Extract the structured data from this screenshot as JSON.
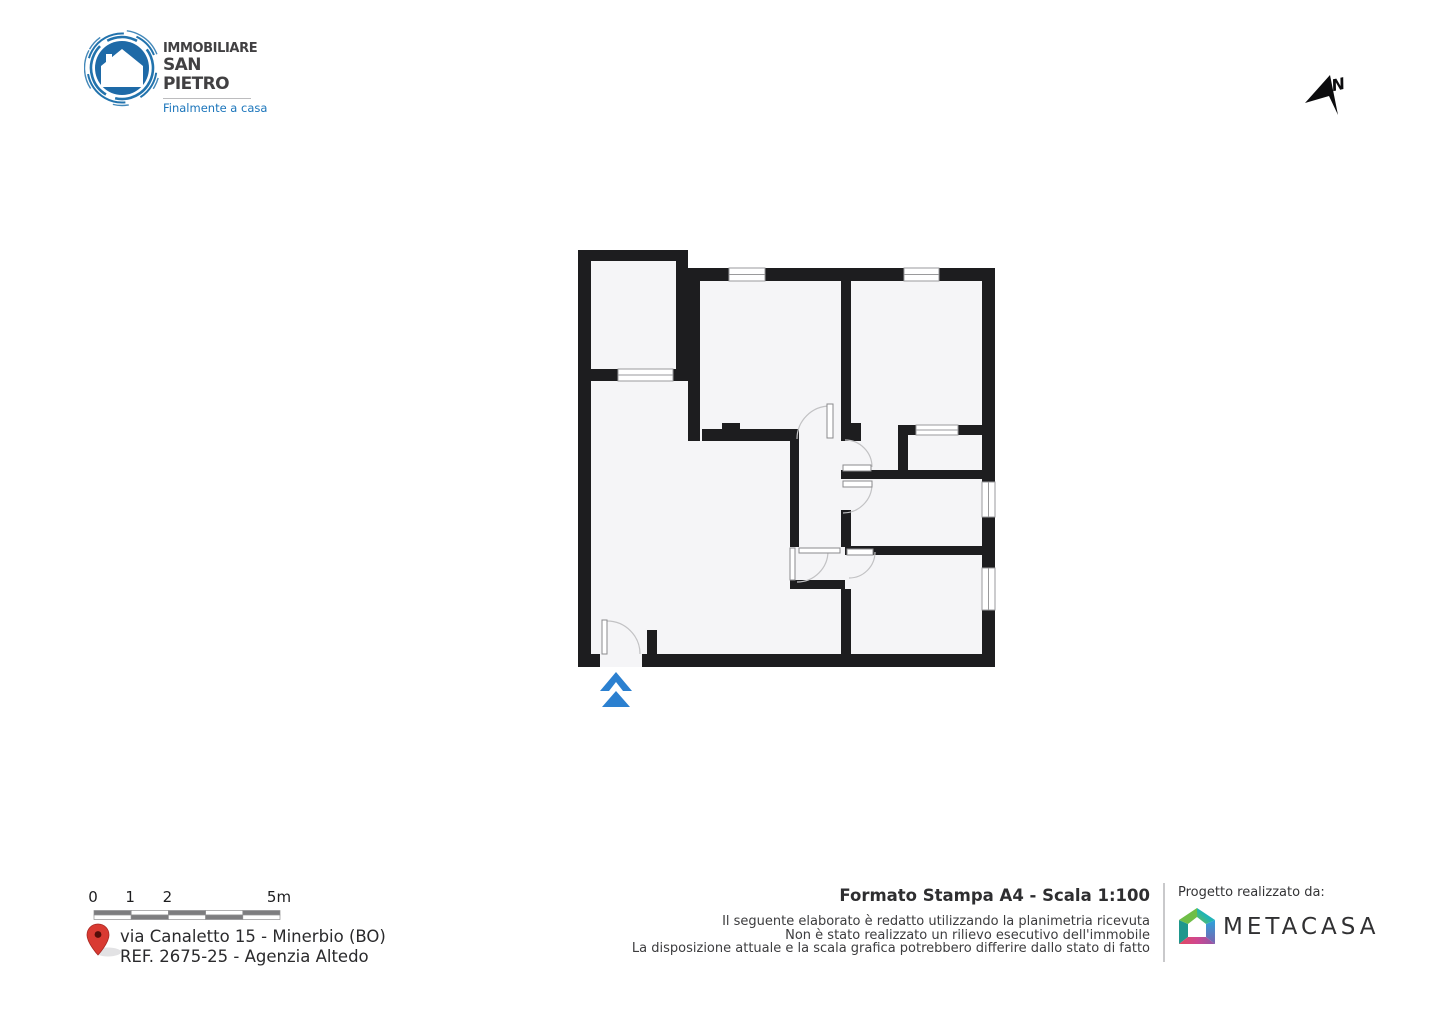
{
  "branding": {
    "line1": "IMMOBILIARE",
    "line2": "SAN PIETRO",
    "tagline": "Finalmente a casa",
    "brand_blue": "#1e6aa7",
    "tagline_blue": "#1b75bb"
  },
  "north_indicator": {
    "label": "N"
  },
  "floor_plan": {
    "wall_color": "#1d1d1f",
    "room_fill": "#f5f5f7",
    "window_stroke": "#9a9a9c",
    "arc_stroke": "#c2c2c4",
    "entrance_arrow_color": "#2b80d0",
    "outline_polygon": "578,250 688,250 688,268 995,268 995,667 578,667",
    "walls": [
      [
        578,
        250,
        13,
        417
      ],
      [
        578,
        250,
        110,
        11
      ],
      [
        676,
        261,
        12,
        120
      ],
      [
        578,
        369,
        40,
        12
      ],
      [
        673,
        369,
        15,
        12
      ],
      [
        688,
        268,
        41,
        13
      ],
      [
        765,
        268,
        139,
        13
      ],
      [
        939,
        268,
        56,
        13
      ],
      [
        982,
        268,
        13,
        214
      ],
      [
        982,
        517,
        13,
        51
      ],
      [
        982,
        610,
        13,
        57
      ],
      [
        578,
        654,
        22,
        13
      ],
      [
        642,
        654,
        353,
        13
      ],
      [
        688,
        281,
        12,
        160
      ],
      [
        841,
        281,
        10,
        142
      ],
      [
        841,
        423,
        20,
        18
      ],
      [
        702,
        429,
        95,
        12
      ],
      [
        722,
        423,
        18,
        18
      ],
      [
        790,
        429,
        9,
        118
      ],
      [
        841,
        470,
        141,
        9
      ],
      [
        841,
        510,
        10,
        37
      ],
      [
        898,
        425,
        10,
        45
      ],
      [
        898,
        425,
        18,
        10
      ],
      [
        958,
        425,
        24,
        10
      ],
      [
        845,
        546,
        137,
        9
      ],
      [
        790,
        580,
        55,
        9
      ],
      [
        841,
        589,
        10,
        65
      ],
      [
        647,
        630,
        10,
        24
      ]
    ],
    "windows": [
      {
        "rect": [
          729,
          268,
          36,
          13
        ],
        "dir": "h"
      },
      {
        "rect": [
          904,
          268,
          35,
          13
        ],
        "dir": "h"
      },
      {
        "rect": [
          618,
          369,
          55,
          12
        ],
        "dir": "h"
      },
      {
        "rect": [
          916,
          425,
          42,
          10
        ],
        "dir": "h"
      },
      {
        "rect": [
          982,
          482,
          13,
          35
        ],
        "dir": "v"
      },
      {
        "rect": [
          982,
          568,
          13,
          42
        ],
        "dir": "v"
      }
    ],
    "door_leaves": [
      [
        602,
        620,
        5,
        34
      ],
      [
        827,
        404,
        6,
        34
      ],
      [
        843,
        465,
        28,
        6
      ],
      [
        843,
        481,
        29,
        6
      ],
      [
        847,
        549,
        26,
        6
      ],
      [
        790,
        548,
        5,
        32
      ],
      [
        799,
        548,
        41,
        5
      ]
    ],
    "door_arcs": [
      "M 607,621 A 33 33 0 0 1 640,654",
      "M 830,406 A 33 33 0 0 0 797,439",
      "M 845,440 A 27 27 0 0 1 872,467",
      "M 872,484 A 29 29 0 0 1 843,513",
      "M 875,552 A 26 26 0 0 1 849,578",
      "M 828,551 A 31 31 0 0 1 797,582"
    ],
    "entrance_arrow": {
      "chevron": "M 616,672 L 632,691 L 623,691 L 616,682 L 609,691 L 600,691 Z",
      "triangle": "M 616,691 L 630,707 L 602,707 Z"
    }
  },
  "scale_bar": {
    "marks": [
      {
        "label": "0",
        "pos": 0
      },
      {
        "label": "1",
        "pos": 1
      },
      {
        "label": "2",
        "pos": 2
      },
      {
        "label": "5m",
        "pos": 5
      }
    ],
    "segments": 5,
    "origin_x": 93,
    "length": 186,
    "dark": "#7d7d7f",
    "border": "#8f8f91"
  },
  "address": {
    "line1": "via Canaletto 15 - Minerbio (BO)",
    "line2": "REF. 2675-25 - Agenzia Altedo",
    "pin_red": "#d93a32"
  },
  "print_info": {
    "title": "Formato Stampa A4 - Scala 1:100",
    "disclaimer": [
      "Il seguente elaborato è redatto utilizzando la planimetria ricevuta",
      "Non è stato realizzato un rilievo esecutivo dell'immobile",
      "La disposizione attuale e la scala grafica potrebbero differire dallo stato di fatto"
    ]
  },
  "credits": {
    "label": "Progetto realizzato da:",
    "brand": "METACASA"
  }
}
